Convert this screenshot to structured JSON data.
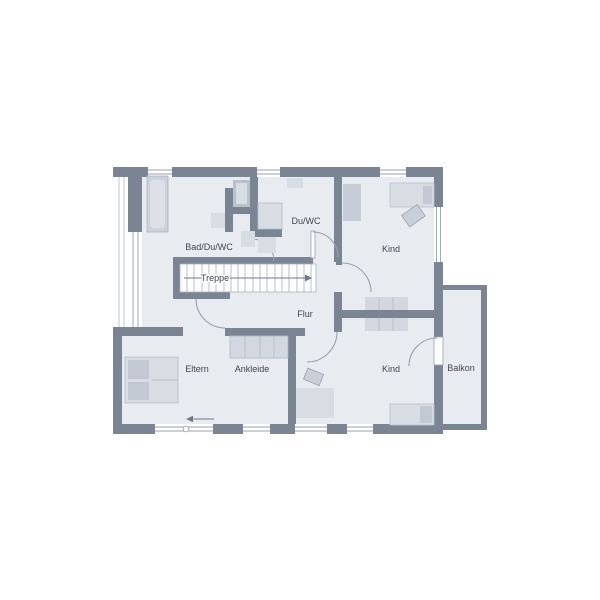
{
  "floor_plan": {
    "rooms": {
      "bad_du_wc": {
        "label": "Bad/Du/WC"
      },
      "du_wc": {
        "label": "Du/WC"
      },
      "kind_top": {
        "label": "Kind"
      },
      "treppe": {
        "label": "Treppe"
      },
      "flur": {
        "label": "Flur"
      },
      "eltern": {
        "label": "Eltern"
      },
      "ankleide": {
        "label": "Ankleide"
      },
      "kind_bottom": {
        "label": "Kind"
      },
      "balkon": {
        "label": "Balkon"
      }
    },
    "colors": {
      "wall": "#7b8493",
      "room_fill": "#e8ebf0",
      "furniture_light": "#d8dce3",
      "furniture_medium": "#c3c9d3",
      "stair_fill": "#fdfdfe",
      "outline": "#98a1ae",
      "text": "#41464f",
      "background": "#ffffff"
    }
  }
}
